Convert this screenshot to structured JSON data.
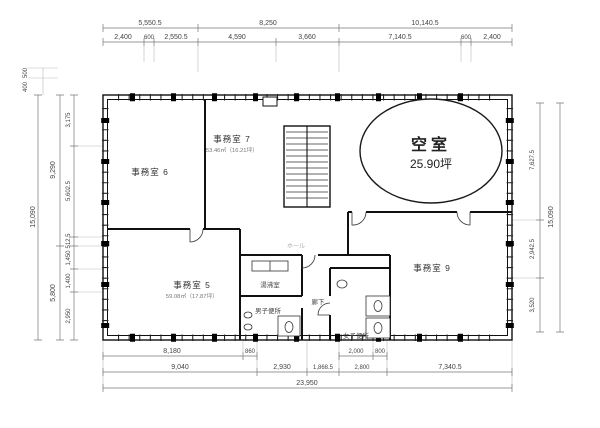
{
  "plan": {
    "vacancy": {
      "name": "空室",
      "area": "25.90坪"
    },
    "rooms": {
      "office6": {
        "name": "事務室 6"
      },
      "office7": {
        "name": "事務室 7",
        "area": "53.46㎡（16.21坪）"
      },
      "office5": {
        "name": "事務室 5",
        "area": "59.08㎡（17.87坪）"
      },
      "office9": {
        "name": "事務室 9"
      },
      "kitchenette": {
        "name": "湯沸室"
      },
      "mens_toilet": {
        "name": "男子便所"
      },
      "womens_toilet": {
        "name": "女子便所"
      },
      "corridor": {
        "name": "廊下"
      },
      "hall": {
        "name": "ホール"
      }
    },
    "dims": {
      "top1": [
        "5,550.5",
        "8,250",
        "10,140.5"
      ],
      "top2": [
        "2,400",
        "600",
        "2,550.5",
        "4,590",
        "3,660",
        "7,140.5",
        "600",
        "2,400"
      ],
      "bottom1": [
        "8,180",
        "860",
        "2,000",
        "800"
      ],
      "bottom2": [
        "9,040",
        "2,930",
        "1,868.5",
        "2,800",
        "7,340.5"
      ],
      "bottom_total": "23,950",
      "left_outer": "15,090",
      "left_mid": [
        "9,290",
        "5,800"
      ],
      "left_inner": [
        "3,175",
        "5,602.5",
        "512.5",
        "1,450",
        "1,400",
        "2,950"
      ],
      "left_top": [
        "500",
        "400"
      ],
      "right_inner": [
        "7,627.5",
        "2,942.5",
        "3,520"
      ],
      "right_outer": "15,090"
    }
  }
}
